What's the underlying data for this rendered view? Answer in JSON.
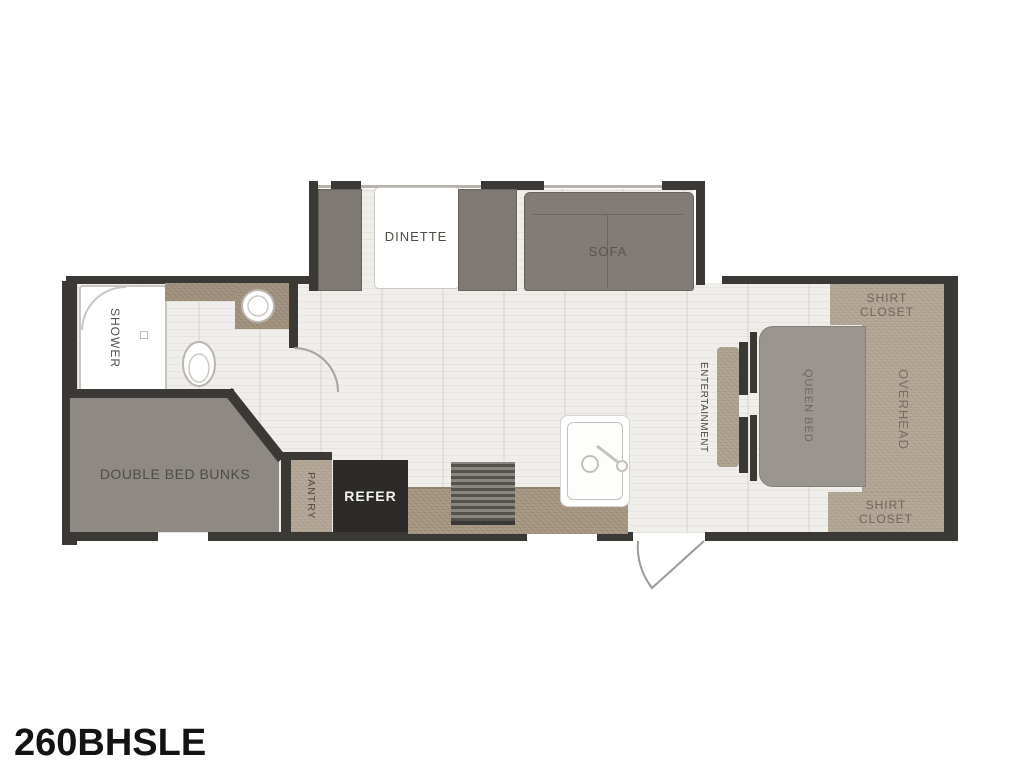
{
  "model": "260BHSLE",
  "rooms": {
    "shower": {
      "label": "SHOWER"
    },
    "dinette": {
      "label": "DINETTE"
    },
    "sofa": {
      "label": "SOFA"
    },
    "bunks": {
      "label": "DOUBLE BED BUNKS"
    },
    "pantry": {
      "label": "PANTRY"
    },
    "refer": {
      "label": "REFER"
    },
    "entertainment": {
      "label": "ENTERTAINMENT"
    },
    "queen_bed": {
      "label": "QUEEN BED"
    },
    "overhead": {
      "label": "OVERHEAD"
    },
    "shirt_closet_top": {
      "label": "SHIRT CLOSET"
    },
    "shirt_closet_bottom": {
      "label": "SHIRT CLOSET"
    }
  },
  "colors": {
    "wall": "#3b3936",
    "floor": "#f0eeea",
    "cabinet_tan": "#b1a492",
    "counter_tan": "#a4947f",
    "bench_gray": "#7e7a73",
    "bed_gray": "#9a968f",
    "bunk_gray": "#8e8a83",
    "refer_black": "#2c2b29",
    "label_dark": "#55514b",
    "label_closet": "#6f6659"
  }
}
